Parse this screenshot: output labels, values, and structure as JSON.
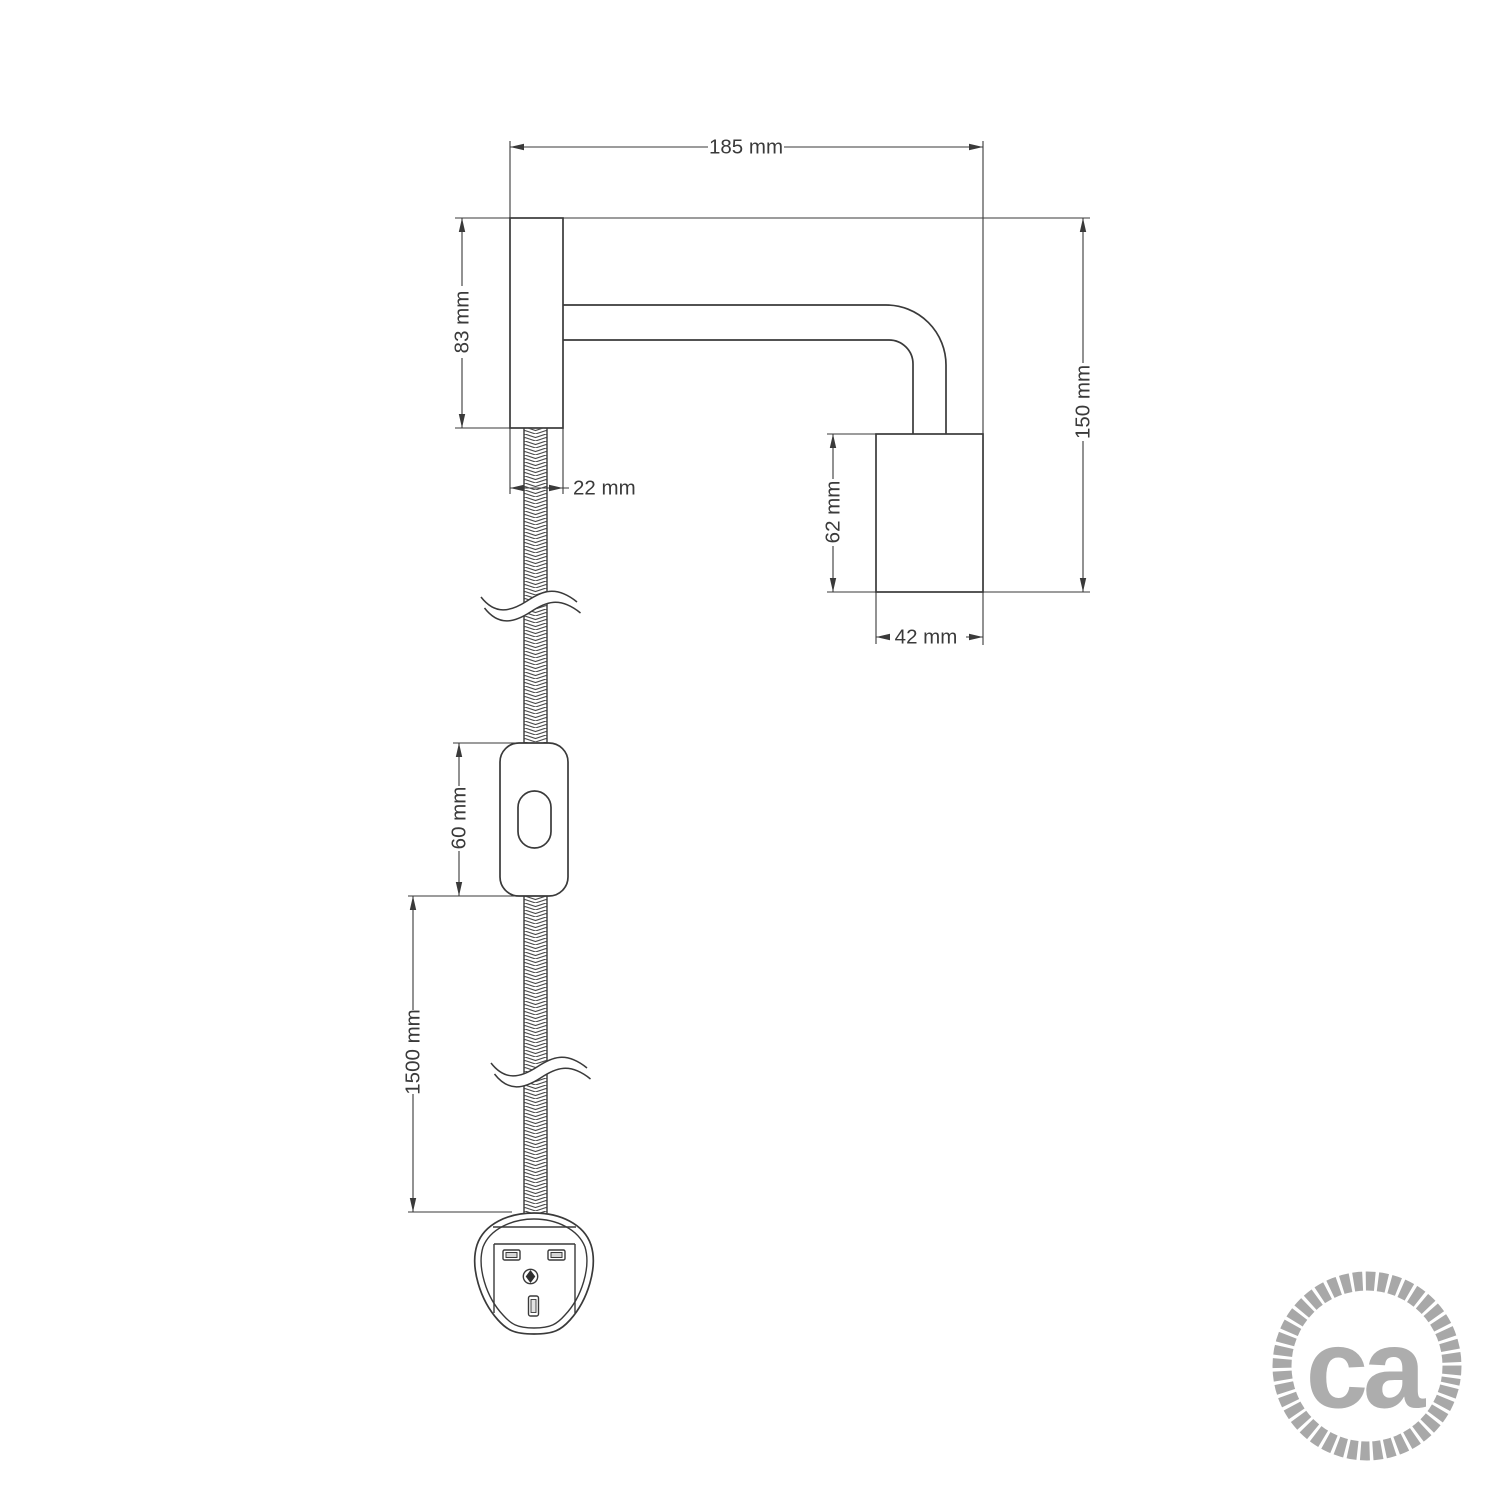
{
  "dimensions": {
    "total_width": "185 mm",
    "plate_height": "83 mm",
    "plate_width": "22 mm",
    "total_height": "150 mm",
    "socket_height": "62 mm",
    "socket_width": "42 mm",
    "switch_length": "60 mm",
    "cable_length": "1500 mm"
  },
  "logo": {
    "text": "ca"
  },
  "colors": {
    "line": "#3a3a3a",
    "logo_gray": "#adadad"
  }
}
